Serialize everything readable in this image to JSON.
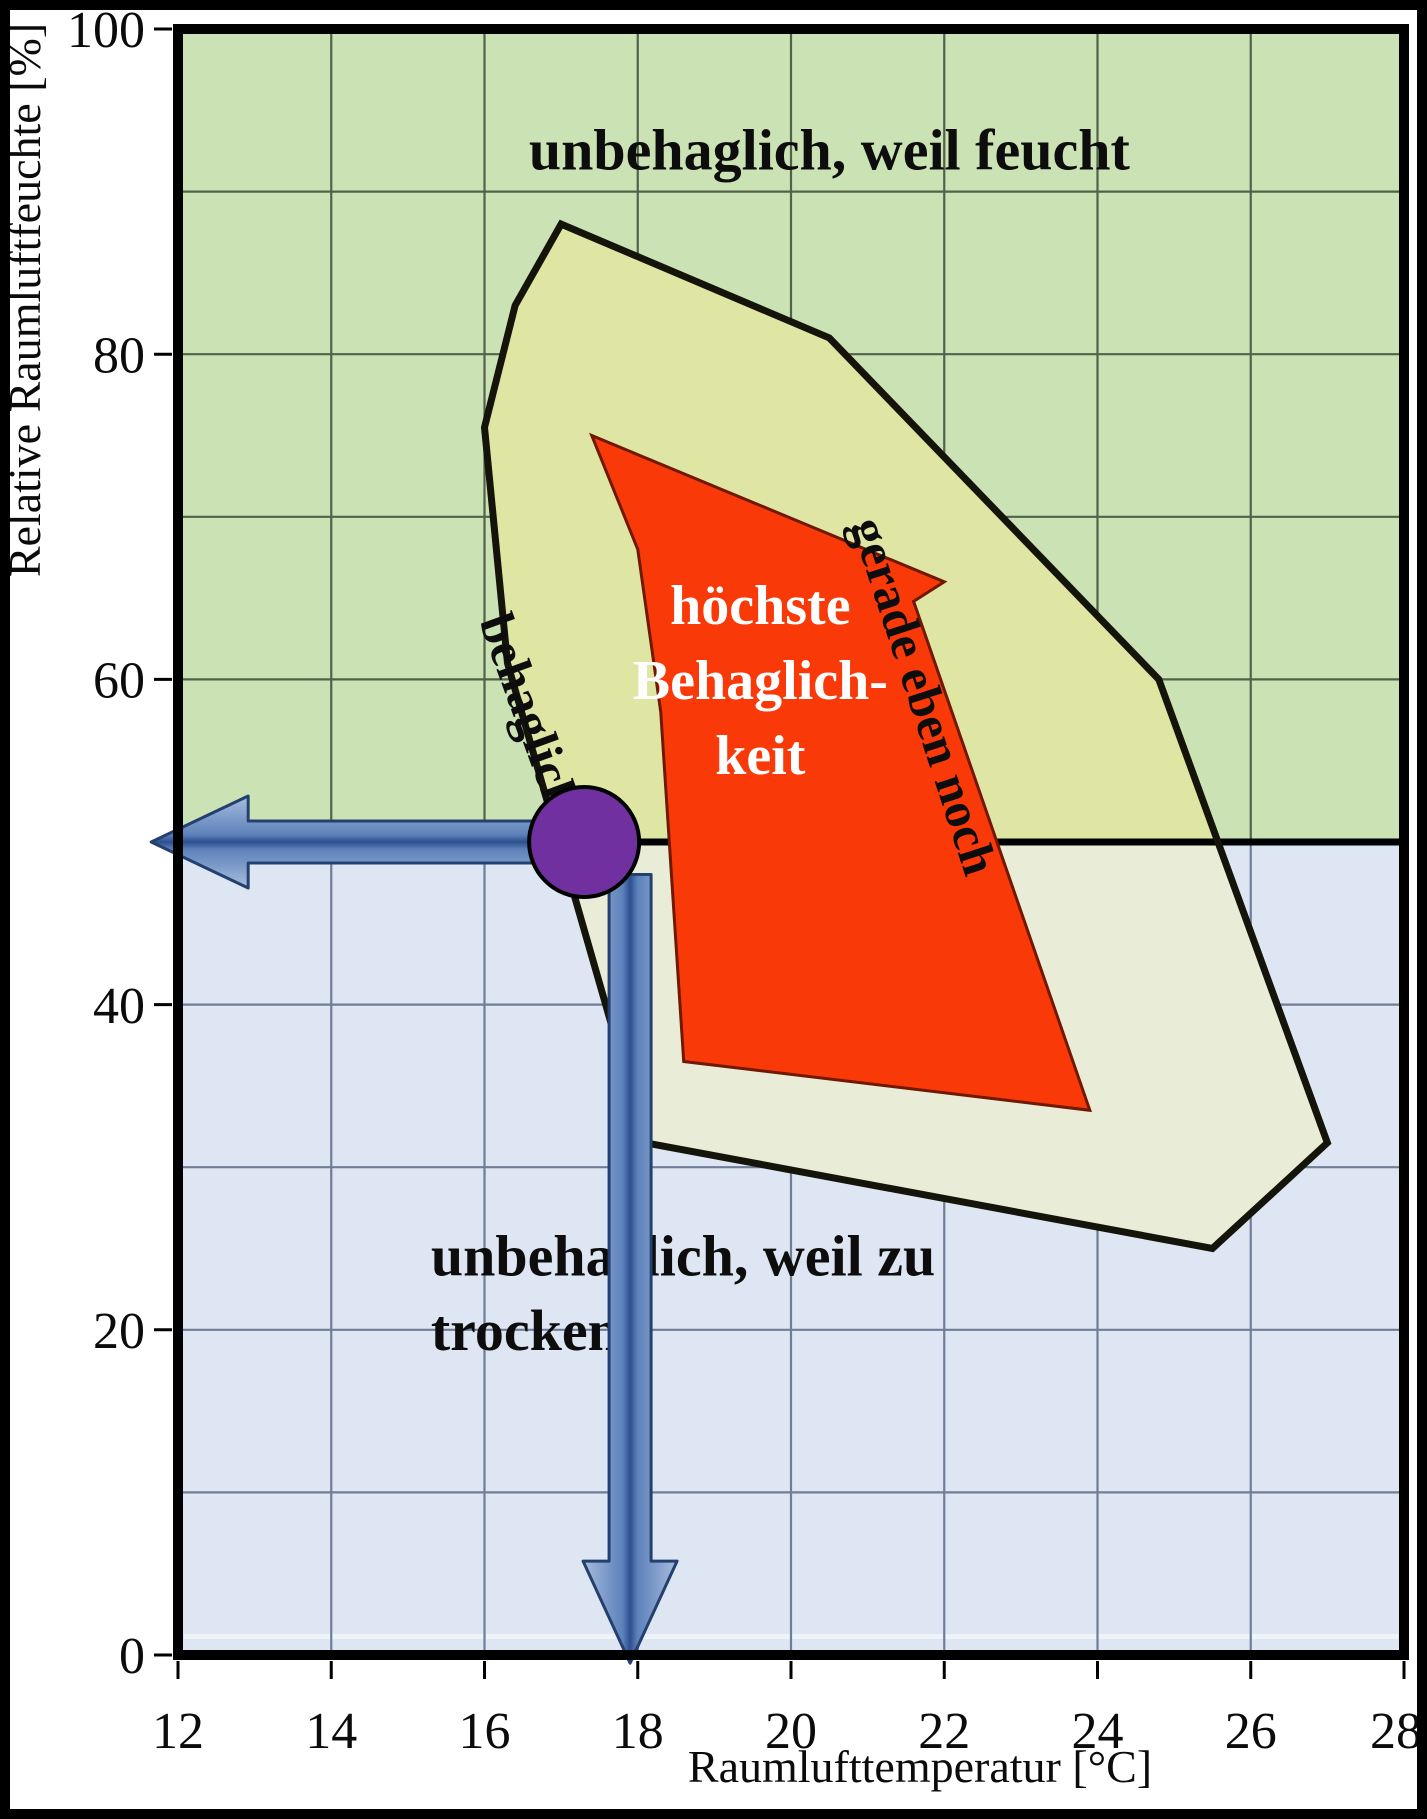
{
  "chart_data": {
    "type": "area",
    "title": "",
    "xlabel": "Raumlufttemperatur [°C]",
    "ylabel": "Relative Raumluftfeuchte [%]",
    "x_range": [
      12,
      28
    ],
    "y_range": [
      0,
      100
    ],
    "x_ticks": [
      12,
      14,
      16,
      18,
      20,
      22,
      24,
      26,
      28
    ],
    "y_ticks": [
      0,
      20,
      40,
      60,
      80,
      100
    ],
    "x_grid_step": 2,
    "y_grid_step": 10,
    "grid_on": true,
    "grid_color_upper": "#52624a",
    "grid_color_lower": "#6f7d96",
    "divider": {
      "humidity": 50,
      "color": "#000000"
    },
    "regions": {
      "humid": {
        "label": "unbehaglich, weil feucht",
        "color": "#cbe2b4",
        "label_color": "#0d0d0d",
        "label_pos": {
          "t": 20.5,
          "rh": 92.6
        }
      },
      "dry": {
        "label_lines": [
          "unbehaglich, weil zu",
          "trocken"
        ],
        "color": "#dde6f2",
        "label_color": "#0d0d0d",
        "label_pos": {
          "t": 15.3,
          "rh_lines": [
            24.6,
            20.0
          ]
        }
      },
      "comfort": {
        "color_above": "#dfe6a4",
        "color_below": "#e9ecd6",
        "outline": "#14140a",
        "points": [
          [
            17,
            88
          ],
          [
            20.5,
            81
          ],
          [
            24.8,
            60
          ],
          [
            27,
            31.5
          ],
          [
            25.5,
            25
          ],
          [
            18.1,
            31.5
          ],
          [
            16.3,
            61
          ],
          [
            16,
            75.5
          ],
          [
            16.4,
            83
          ]
        ],
        "side_label": {
          "text": "behaglich",
          "t": 16.6,
          "rh": 58,
          "angle": 70
        },
        "edge_label": {
          "text": "gerade eben noch",
          "t": 21.75,
          "rh": 59,
          "angle": 72
        }
      },
      "optimal": {
        "color": "#fa3908",
        "outline": "#701800",
        "label_color": "#ffffff",
        "points": [
          [
            17.4,
            75
          ],
          [
            22,
            66
          ],
          [
            21.6,
            64.8
          ],
          [
            23.9,
            33.5
          ],
          [
            18.6,
            36.5
          ],
          [
            18.3,
            58
          ],
          [
            18,
            68
          ]
        ],
        "label_lines": [
          "höchste",
          "Behaglich-",
          "keit"
        ],
        "label_pos": {
          "t": 19.6,
          "rh_lines": [
            64.6,
            60.0,
            55.4
          ]
        }
      }
    },
    "marker": {
      "t": 17.3,
      "rh": 50,
      "color": "#7030a0",
      "outline": "#000000"
    },
    "arrows": {
      "fill_light": "#a8bcdd",
      "fill_mid": "#5d82bb",
      "fill_dark": "#2d4f8e",
      "outline": "#24406f",
      "horizontal": {
        "rh": 50,
        "tail_t": 17.3,
        "tip_t": 11.65
      },
      "vertical": {
        "t": 17.9,
        "tail_rh": 48,
        "tip_rh": -0.5
      }
    }
  }
}
